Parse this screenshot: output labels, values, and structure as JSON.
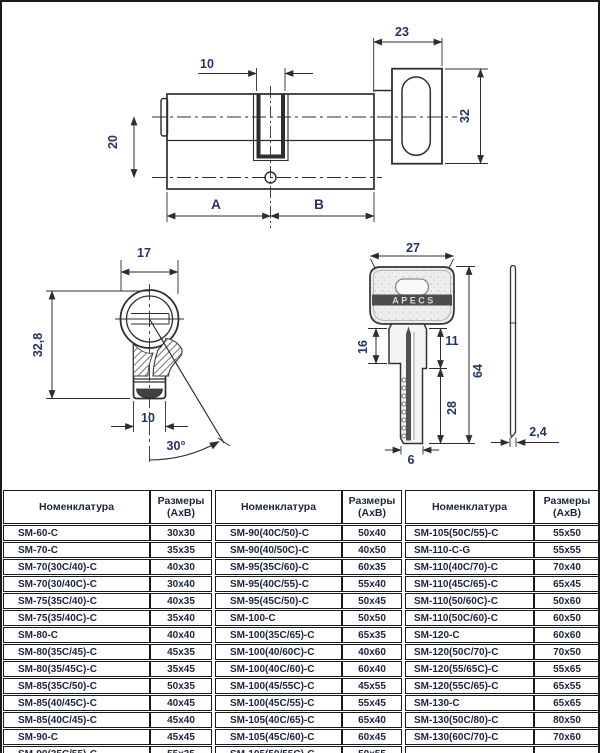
{
  "drawings": {
    "cylinder": {
      "knob_width": "23",
      "cam_width": "10",
      "axis_offset": "20",
      "knob_height": "32",
      "dim_a": "A",
      "dim_b": "B"
    },
    "end_view": {
      "diameter": "17",
      "height": "32,8",
      "width": "10",
      "cam_angle": "30°"
    },
    "key": {
      "brand": "APECS",
      "head_width": "27",
      "shoulder_len": "16",
      "neck_len": "11",
      "total_len": "64",
      "blade_len": "28",
      "tip_width": "6",
      "thickness": "2,4"
    }
  },
  "tables": [
    {
      "header": {
        "col1": "Номенклатура",
        "col2_line1": "Размеры",
        "col2_line2": "(АхВ)"
      },
      "rows": [
        {
          "name": "SM-60-C",
          "size": "30x30"
        },
        {
          "name": "SM-70-C",
          "size": "35x35"
        },
        {
          "name": "SM-70(30C/40)-C",
          "size": "40x30"
        },
        {
          "name": "SM-70(30/40C)-C",
          "size": "30x40"
        },
        {
          "name": "SM-75(35C/40)-C",
          "size": "40x35"
        },
        {
          "name": "SM-75(35/40C)-C",
          "size": "35x40"
        },
        {
          "name": "SM-80-C",
          "size": "40x40"
        },
        {
          "name": "SM-80(35C/45)-C",
          "size": "45x35"
        },
        {
          "name": "SM-80(35/45C)-C",
          "size": "35x45"
        },
        {
          "name": "SM-85(35C/50)-C",
          "size": "50x35"
        },
        {
          "name": "SM-85(40/45C)-C",
          "size": "40x45"
        },
        {
          "name": "SM-85(40C/45)-C",
          "size": "45x40"
        },
        {
          "name": "SM-90-C",
          "size": "45x45"
        },
        {
          "name": "SM-90(35C/55)-C",
          "size": "55x35"
        },
        {
          "name": "",
          "size": ""
        }
      ]
    },
    {
      "header": {
        "col1": "Номенклатура",
        "col2_line1": "Размеры",
        "col2_line2": "(АхВ)"
      },
      "rows": [
        {
          "name": "SM-90(40C/50)-C",
          "size": "50x40"
        },
        {
          "name": "SM-90(40/50C)-C",
          "size": "40x50"
        },
        {
          "name": "SM-95(35C/60)-C",
          "size": "60x35"
        },
        {
          "name": "SM-95(40C/55)-C",
          "size": "55x40"
        },
        {
          "name": "SM-95(45C/50)-C",
          "size": "50x45"
        },
        {
          "name": "SM-100-C",
          "size": "50x50"
        },
        {
          "name": "SM-100(35C/65)-C",
          "size": "65x35"
        },
        {
          "name": "SM-100(40/60C)-C",
          "size": "40x60"
        },
        {
          "name": "SM-100(40C/60)-C",
          "size": "60x40"
        },
        {
          "name": "SM-100(45/55C)-C",
          "size": "45x55"
        },
        {
          "name": "SM-100(45C/55)-C",
          "size": "55x45"
        },
        {
          "name": "SM-105(40C/65)-C",
          "size": "65x40"
        },
        {
          "name": "SM-105(45C/60)-C",
          "size": "60x45"
        },
        {
          "name": "SM-105(50/55C)-C",
          "size": "50x55"
        },
        {
          "name": "",
          "size": ""
        }
      ]
    },
    {
      "header": {
        "col1": "Номенклатура",
        "col2_line1": "Размеры",
        "col2_line2": "(АхВ)"
      },
      "rows": [
        {
          "name": "SM-105(50C/55)-C",
          "size": "55x50"
        },
        {
          "name": "SM-110-C-G",
          "size": "55x55"
        },
        {
          "name": "SM-110(40C/70)-C",
          "size": "70x40"
        },
        {
          "name": "SM-110(45C/65)-C",
          "size": "65x45"
        },
        {
          "name": "SM-110(50/60C)-C",
          "size": "50x60"
        },
        {
          "name": "SM-110(50C/60)-C",
          "size": "60x50"
        },
        {
          "name": "SM-120-C",
          "size": "60x60"
        },
        {
          "name": "SM-120(50C/70)-C",
          "size": "70x50"
        },
        {
          "name": "SM-120(55/65C)-C",
          "size": "55x65"
        },
        {
          "name": "SM-120(55C/65)-C",
          "size": "65x55"
        },
        {
          "name": "SM-130-C",
          "size": "65x65"
        },
        {
          "name": "SM-130(50C/80)-C",
          "size": "80x50"
        },
        {
          "name": "SM-130(60C/70)-C",
          "size": "70x60"
        },
        {
          "name": "",
          "size": ""
        },
        {
          "name": "",
          "size": ""
        }
      ]
    }
  ]
}
